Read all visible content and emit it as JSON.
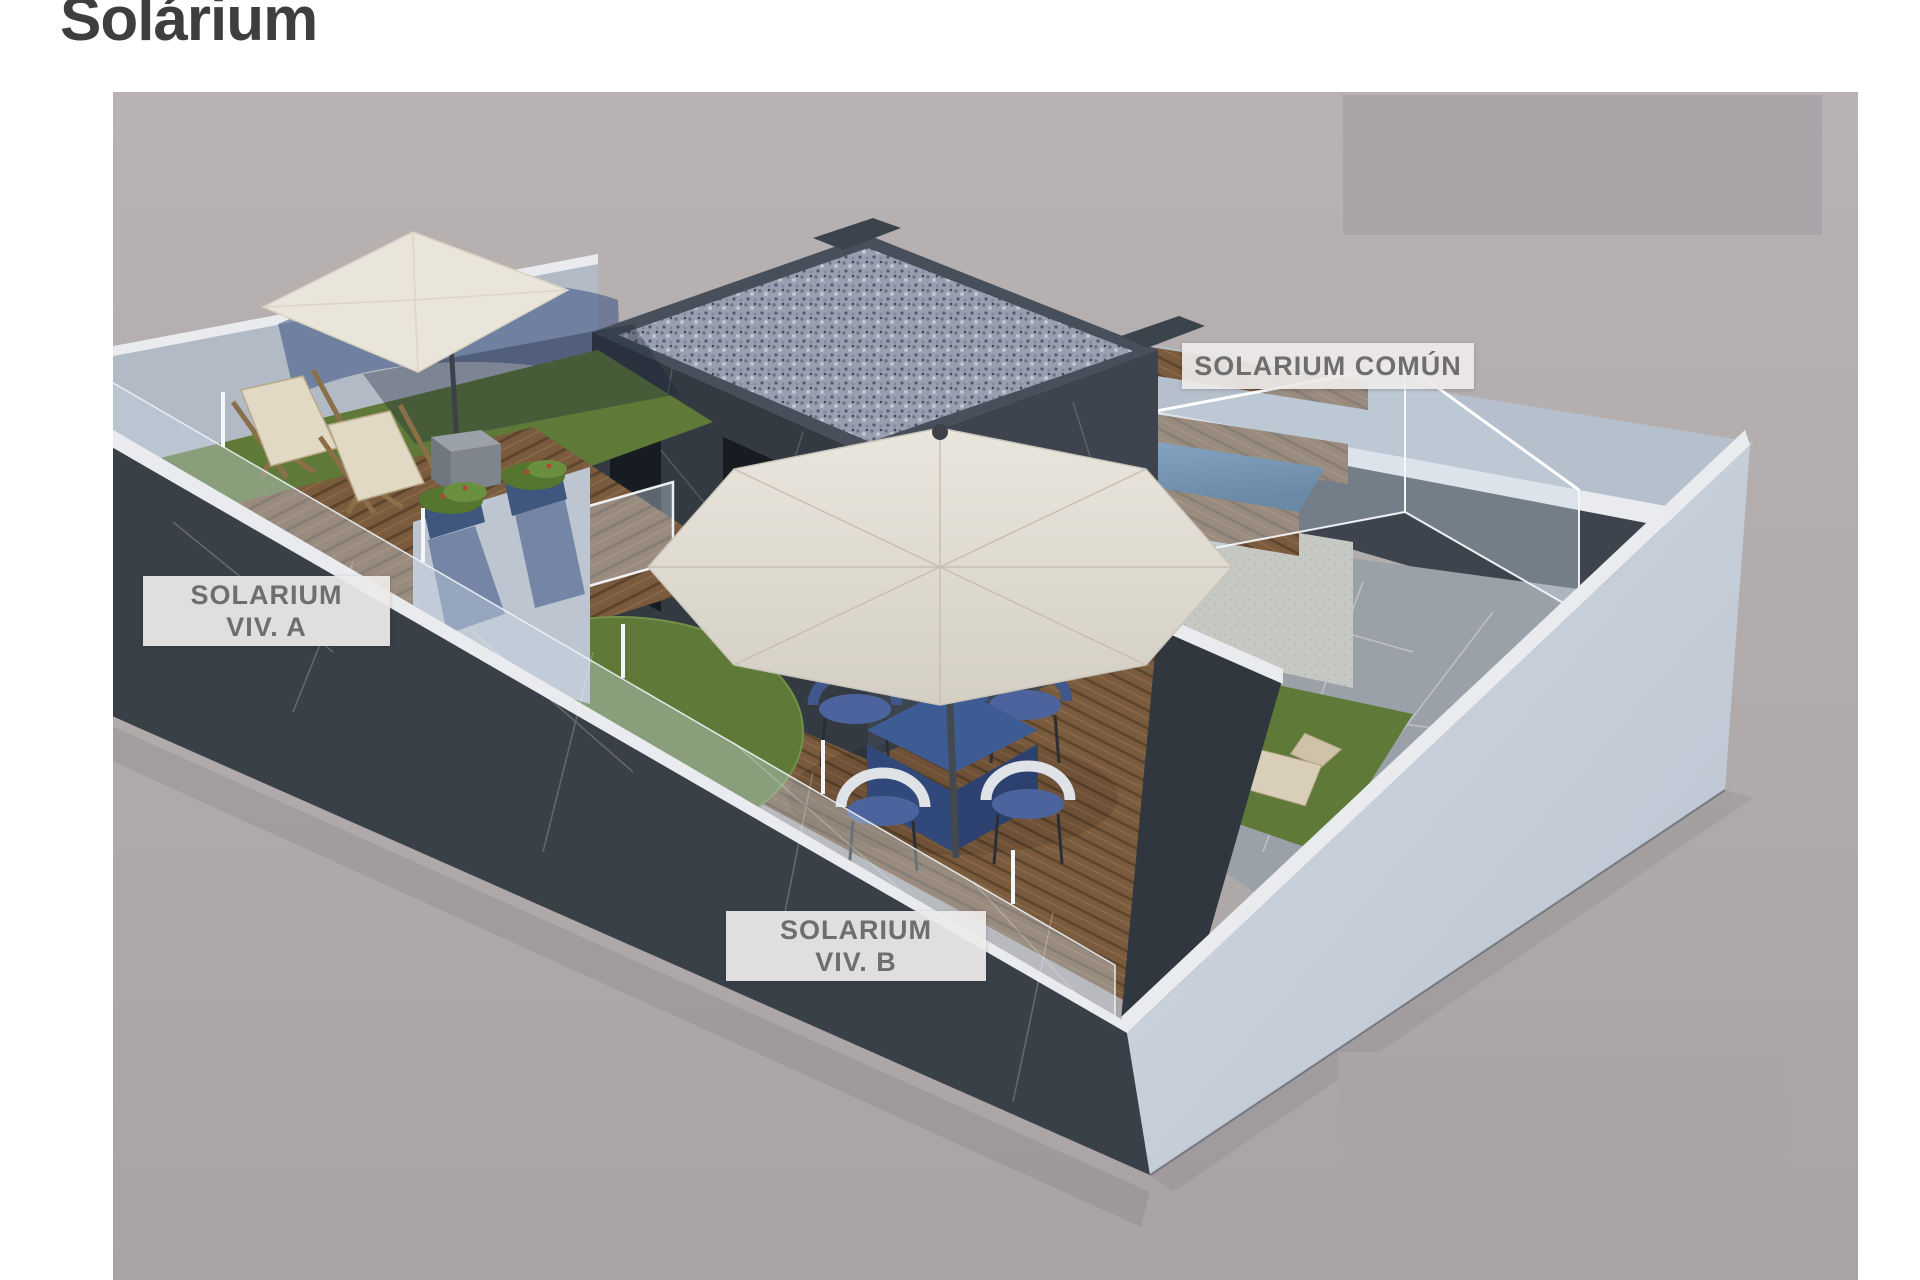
{
  "page": {
    "title": "Solárium"
  },
  "render": {
    "type": "3d-axonometric-architectural-render",
    "subject": "rooftop solarium level of a duplex building",
    "zone_labels": {
      "viv_a": {
        "line1": "SOLARIUM",
        "line2": "VIV. A"
      },
      "viv_b": {
        "line1": "SOLARIUM",
        "line2": "VIV. B"
      },
      "comun": {
        "text": "SOLARIUM COMÚN"
      }
    },
    "zones": [
      "private solarium dwelling A: wood deck, lawn, two deck chairs, cream square parasol",
      "private solarium dwelling B: wood deck, round lawn, blue dining table with four wicker chairs, white parasol",
      "shared solarium: raised plunge pool, wood steps, glass balustrade, stone paving, lawn with two loungers",
      "central core volume with gravel roof and access doors"
    ]
  },
  "palette": {
    "page-bg": "#ffffff",
    "title-color": "#3d3e40",
    "ground-top": "#b8b2b2",
    "ground-bottom": "#a9a3a5",
    "redact-grey": "#a8a4a7",
    "label-bg": "rgba(237,235,233,0.93)",
    "label-text": "#6e6e6e",
    "marble-dark": "#394048",
    "marble-dark-2": "#333a42",
    "marble-dark-3": "#3d444d",
    "marble-divider": "#30373f",
    "marble-light-face": "#c9d1dc",
    "parapet-top": "#b6bfcc",
    "cap-white": "#e9ebee",
    "plaster-wall": "#b2bac6",
    "glass-tint": "rgba(200,215,228,0.40)",
    "glass-edge": "rgba(243,247,250,0.95)",
    "wood-mid": "#7a5a3c",
    "wood-dark": "#5e452d",
    "grass": "#5f7a38",
    "grass-dark": "#4c6530",
    "grass-shadow": "rgba(25,35,55,0.35)",
    "stone-floor": "#9ba1a8",
    "pool-base": "#c6c8c3",
    "pool-light": "#6e96c2",
    "pool-dark": "#2a567e",
    "gravel-base": "#98a0b0",
    "canopy-cream": "#e9e5da",
    "canopy-white": "#e0dcd3",
    "table-blue": "#3e5c94",
    "table-blue-side": "#31497a",
    "chair-blue": "#40578c",
    "chair-white": "#dfe3e8",
    "cushion-blue": "#4d639e",
    "shadow-blue": "rgba(58,80,130,0.55)",
    "plant-green": "#56762f",
    "plant-green-2": "#6a8f3f",
    "planter-blue": "#3f567e",
    "lounger-beige": "#d9cfb9",
    "lounger-beige-2": "#cfc2a8",
    "pole-grey": "#44494f",
    "door-dark": "#171c22",
    "knob-yellow": "#d9b94a"
  }
}
